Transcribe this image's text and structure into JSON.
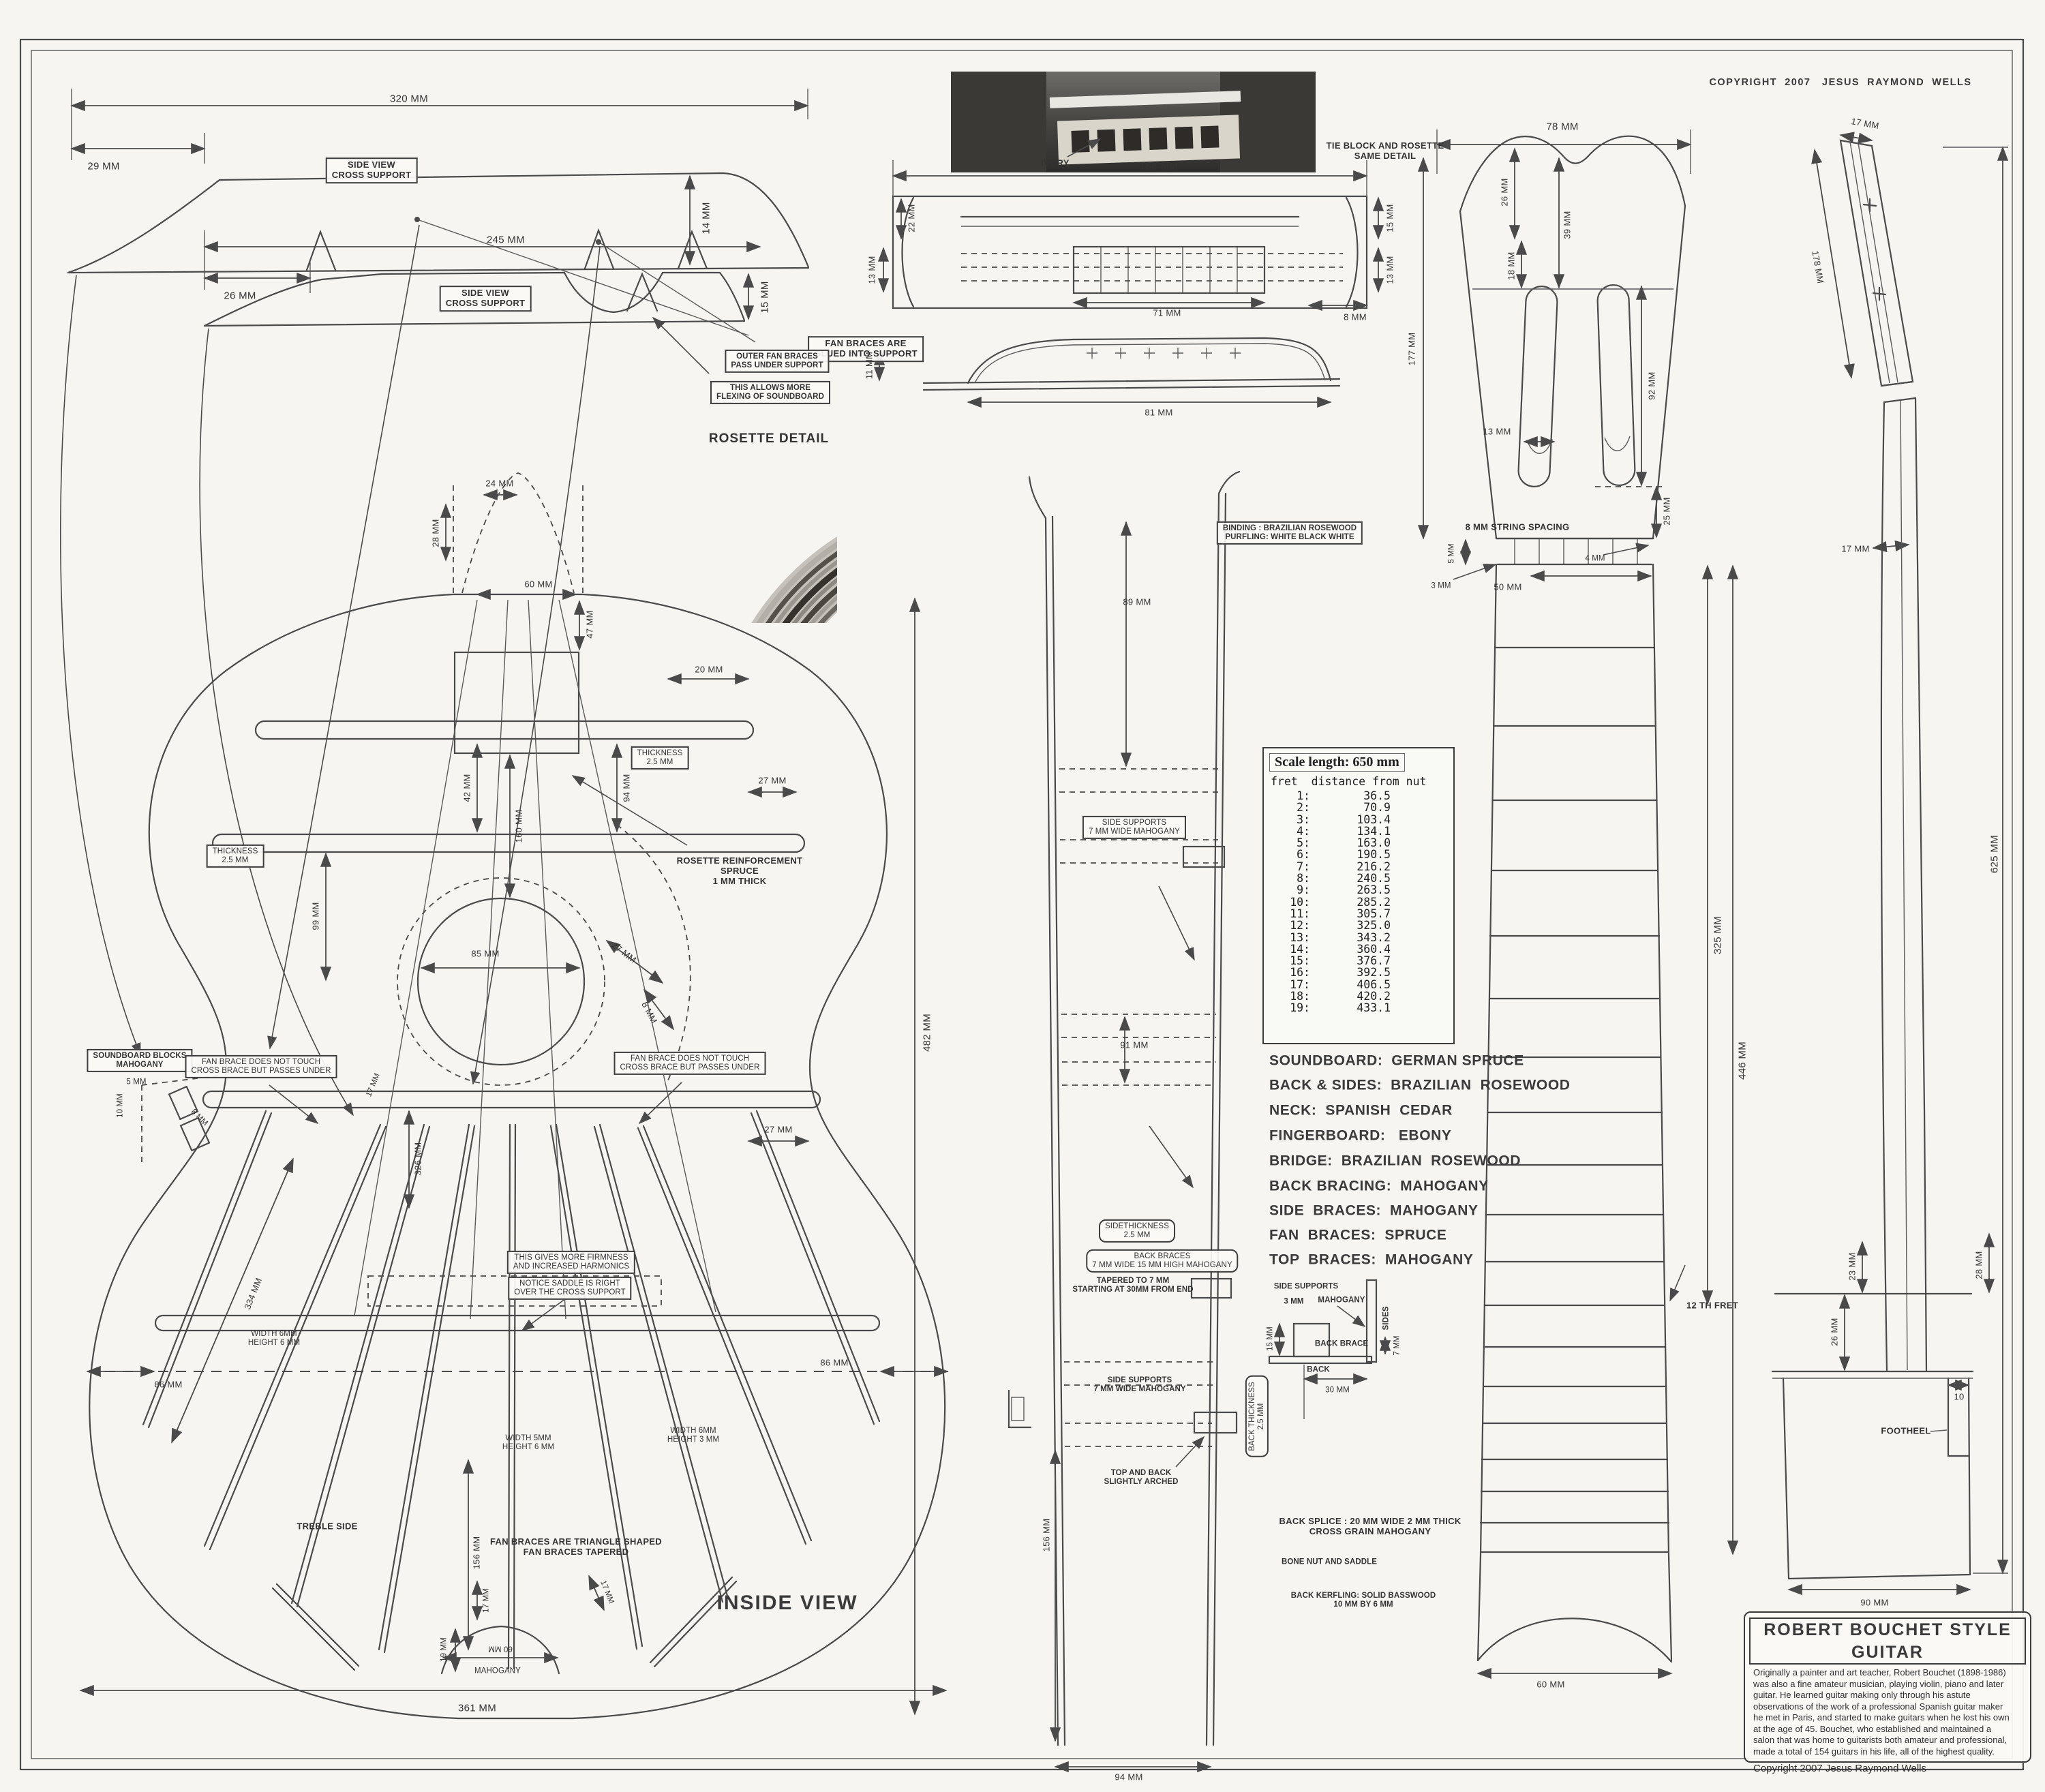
{
  "sheet": {
    "copyright_top": "COPYRIGHT  2007   JESUS  RAYMOND  WELLS",
    "rosette_detail": "ROSETTE  DETAIL",
    "inside_view": "INSIDE VIEW",
    "treble_side": "TREBLE  SIDE"
  },
  "labels": {
    "a320": "320 MM",
    "a29": "29 MM",
    "sv1": "SIDE VIEW\nCROSS  SUPPORT",
    "a14": "14 MM",
    "fanglue": "FAN  BRACES ARE\nGLUED INTO SUPPORT",
    "a245": "245  MM",
    "a26": "26 MM",
    "sv2": "SIDE VIEW\nCROSS  SUPPORT",
    "a15": "15 MM",
    "outerfan": "OUTER FAN BRACES\nPASS UNDER SUPPORT",
    "flexing": "THIS ALLOWS  MORE\nFLEXING OF SOUNDBOARD",
    "b24": "24 MM",
    "b28": "28 MM",
    "b60": "60 MM",
    "b47": "47 MM",
    "b20": "20 MM",
    "b42": "42 MM",
    "b94": "94 MM",
    "b27a": "27 MM",
    "th1": "THICKNESS\n2.5 MM",
    "th2": "THICKNESS\n2.5 MM",
    "b99": "99 MM",
    "b160": "160 MM",
    "rosref": "ROSETTE  REINFORCEMENT\nSPRUCE\n1 MM THICK",
    "b85": "85 MM",
    "b27b": "27 MM",
    "b8": "8 MM",
    "b27c": "27 MM",
    "sbblocks": "SOUNDBOARD  BLOCKS\nMAHOGANY",
    "c5": "5 MM",
    "c10": "10 MM",
    "c8": "8 MM",
    "fbnl": "FAN BRACE DOES NOT TOUCH\nCROSS BRACE  BUT PASSES UNDER",
    "fbnr": "FAN BRACE DOES NOT TOUCH\nCROSS BRACE  BUT PASSES UNDER",
    "d334": "334  MM",
    "d17a": "17 MM",
    "d326": "326  MM",
    "thisgives": "THIS GIVES MORE FIRMNESS\nAND INCREASED  HARMONICS",
    "notice": "NOTICE SADDLE  IS RIGHT\nOVER THE CROSS  SUPPORT",
    "w1": "WIDTH 6MM\nHEIGHT 6 MM",
    "w2": "WIDTH 5MM\nHEIGHT 6 MM",
    "w3": "WIDTH 6MM\nHEIGHT 3 MM",
    "e86l": "86  MM",
    "e86r": "86  MM",
    "e482": "482  MM",
    "e156": "156 MM",
    "tri": "FAN BRACES ARE TRIANGLE SHAPED\nFAN BRACES  TAPERED",
    "f17l": "17 MM",
    "f17r": "17 MM",
    "f19": "19 MM",
    "f60": "60 MM",
    "fmah": "MAHOGANY",
    "e361": "361  MM",
    "ivory": "IVORY",
    "tieblock": "TIE BLOCK  AND ROSETTE\nSAME DETAIL",
    "g188": "188 MM",
    "g15": "15 MM",
    "g13l": "13 MM",
    "g13r": "13 MM",
    "g22": "22 MM",
    "g71": "71  MM",
    "g8": "8  MM",
    "g81": "81 MM",
    "g11": "11 MM",
    "h78": "78 MM",
    "h26": "26 MM",
    "h39": "39 MM",
    "h18": "18  MM",
    "h92": "92 MM",
    "h13": "13 MM",
    "h25": "25 MM",
    "hstr": "8 MM  STRING  SPACING",
    "h5": "5 MM",
    "h3": "3  MM",
    "h50": "50 MM",
    "h4": "4  MM",
    "h177": "177  MM",
    "i325": "325 MM",
    "i446": "446  MM",
    "i12th": "12 TH  FRET",
    "i60": "60 MM",
    "j17top": "17 MM",
    "j178": "178  MM",
    "j17nut": "17 MM",
    "j625": "625  MM",
    "j23": "23 MM",
    "j28": "28 MM",
    "j26": "26 MM",
    "j10": "10",
    "jfoot": "FOOTHEEL",
    "j90": "90  MM",
    "k89": "89 MM",
    "k91": "91 MM",
    "kss1": "SIDE SUPPORTS\n7 MM WIDE  MAHOGANY",
    "ksthick": "SIDETHICKNESS\n2.5 MM",
    "kbb": "BACK  BRACES\n7 MM WIDE  15 MM HIGH  MAHOGANY",
    "ktaper": "TAPERED TO 7 MM\nSTARTING AT 30MM FROM END",
    "kss2": "SIDE SUPPORTS\n7 MM WIDE MAHOGANY",
    "kbthick": "BACK THICKNESS\n2.5 MM",
    "karch": "TOP  AND BACK\nSLIGHTLY  ARCHED",
    "k156": "156 MM",
    "k94": "94  MM",
    "l_ss": "SIDE  SUPPORTS",
    "l_3mm": "3 MM",
    "l_mah": "MAHOGANY",
    "l_sides": "SIDES",
    "l_15": "15 MM",
    "l_bb": "BACK BRACE",
    "l_7": "7 MM",
    "l_back": "BACK",
    "l_30": "30 MM",
    "m_splice": "BACK SPLICE  : 20 MM WIDE  2 MM THICK\nCROSS GRAIN  MAHOGANY",
    "m_bone": "BONE  NUT  AND  SADDLE",
    "m_kerf": "BACK  KERFLING:  SOLID BASSWOOD\n10 MM  BY 6 MM"
  },
  "scale_table": {
    "title": "Scale length: 650 mm",
    "header": "fret  distance from nut",
    "rows": [
      {
        "fret": "1:",
        "dist": "36.5"
      },
      {
        "fret": "2:",
        "dist": "70.9"
      },
      {
        "fret": "3:",
        "dist": "103.4"
      },
      {
        "fret": "4:",
        "dist": "134.1"
      },
      {
        "fret": "5:",
        "dist": "163.0"
      },
      {
        "fret": "6:",
        "dist": "190.5"
      },
      {
        "fret": "7:",
        "dist": "216.2"
      },
      {
        "fret": "8:",
        "dist": "240.5"
      },
      {
        "fret": "9:",
        "dist": "263.5"
      },
      {
        "fret": "10:",
        "dist": "285.2"
      },
      {
        "fret": "11:",
        "dist": "305.7"
      },
      {
        "fret": "12:",
        "dist": "325.0"
      },
      {
        "fret": "13:",
        "dist": "343.2"
      },
      {
        "fret": "14:",
        "dist": "360.4"
      },
      {
        "fret": "15:",
        "dist": "376.7"
      },
      {
        "fret": "16:",
        "dist": "392.5"
      },
      {
        "fret": "17:",
        "dist": "406.5"
      },
      {
        "fret": "18:",
        "dist": "420.2"
      },
      {
        "fret": "19:",
        "dist": "433.1"
      }
    ]
  },
  "materials": [
    "SOUNDBOARD:  GERMAN SPRUCE",
    "BACK & SIDES:  BRAZILIAN  ROSEWOOD",
    "NECK:  SPANISH  CEDAR",
    "FINGERBOARD:   EBONY",
    "BRIDGE:  BRAZILIAN  ROSEWOOD",
    "BACK BRACING:  MAHOGANY",
    "SIDE  BRACES:  MAHOGANY",
    "FAN  BRACES:  SPRUCE",
    "TOP  BRACES:  MAHOGANY"
  ],
  "binding_note": "BINDING :  BRAZILIAN  ROSEWOOD\nPURFLING: WHITE BLACK WHITE",
  "title_block": {
    "title": "ROBERT  BOUCHET   STYLE   GUITAR",
    "description": "Originally a painter and art teacher, Robert Bouchet (1898-1986)\nwas also a fine amateur musician, playing violin, piano and later\nguitar. He learned guitar making only through his astute\nobservations of the work of a professional Spanish guitar maker\nhe met in Paris, and started to make guitars when he lost his own\nat the age of 45. Bouchet, who established and maintained a\nsalon that was home to guitarists both amateur and professional,\nmade a total of 154 guitars in his life, all of the highest quality.",
    "copyright": "Copyright 2007 Jesus Raymond Wells"
  }
}
